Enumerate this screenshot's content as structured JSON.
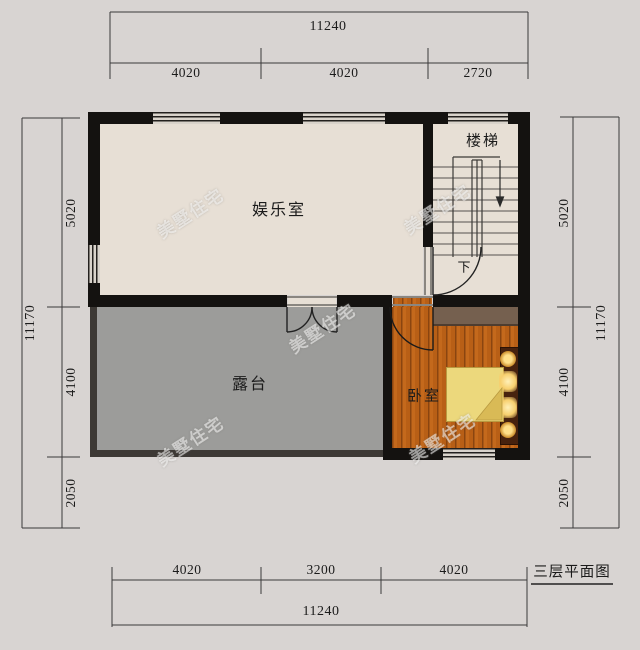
{
  "title": "三层平面图",
  "watermark": {
    "text": "美墅住宅"
  },
  "rooms": {
    "entertainment": "娱乐室",
    "stairs": "楼梯",
    "terrace": "露台",
    "bedroom": "卧室"
  },
  "stairs": {
    "down_label": "下"
  },
  "dims": {
    "top": {
      "total": "11240",
      "segments": [
        "4020",
        "4020",
        "2720"
      ]
    },
    "bottom": {
      "total": "11240",
      "segments": [
        "4020",
        "3200",
        "4020"
      ]
    },
    "left": {
      "total": "11170",
      "segments": [
        "5020",
        "4100",
        "2050"
      ]
    },
    "right": {
      "total": "11170",
      "segments": [
        "5020",
        "4100",
        "2050"
      ]
    }
  },
  "colors": {
    "bg": "#d8d4d2",
    "wall": "#141210",
    "floor": "#e7dfd5",
    "terrace": "#9c9c9a",
    "parapet": "#3d3935",
    "line": "#3a3a3a",
    "wood-a": "#c4691c",
    "wood-b": "#b85f16",
    "wood-seam": "#8a4510",
    "quilt": "#ecd87c"
  }
}
